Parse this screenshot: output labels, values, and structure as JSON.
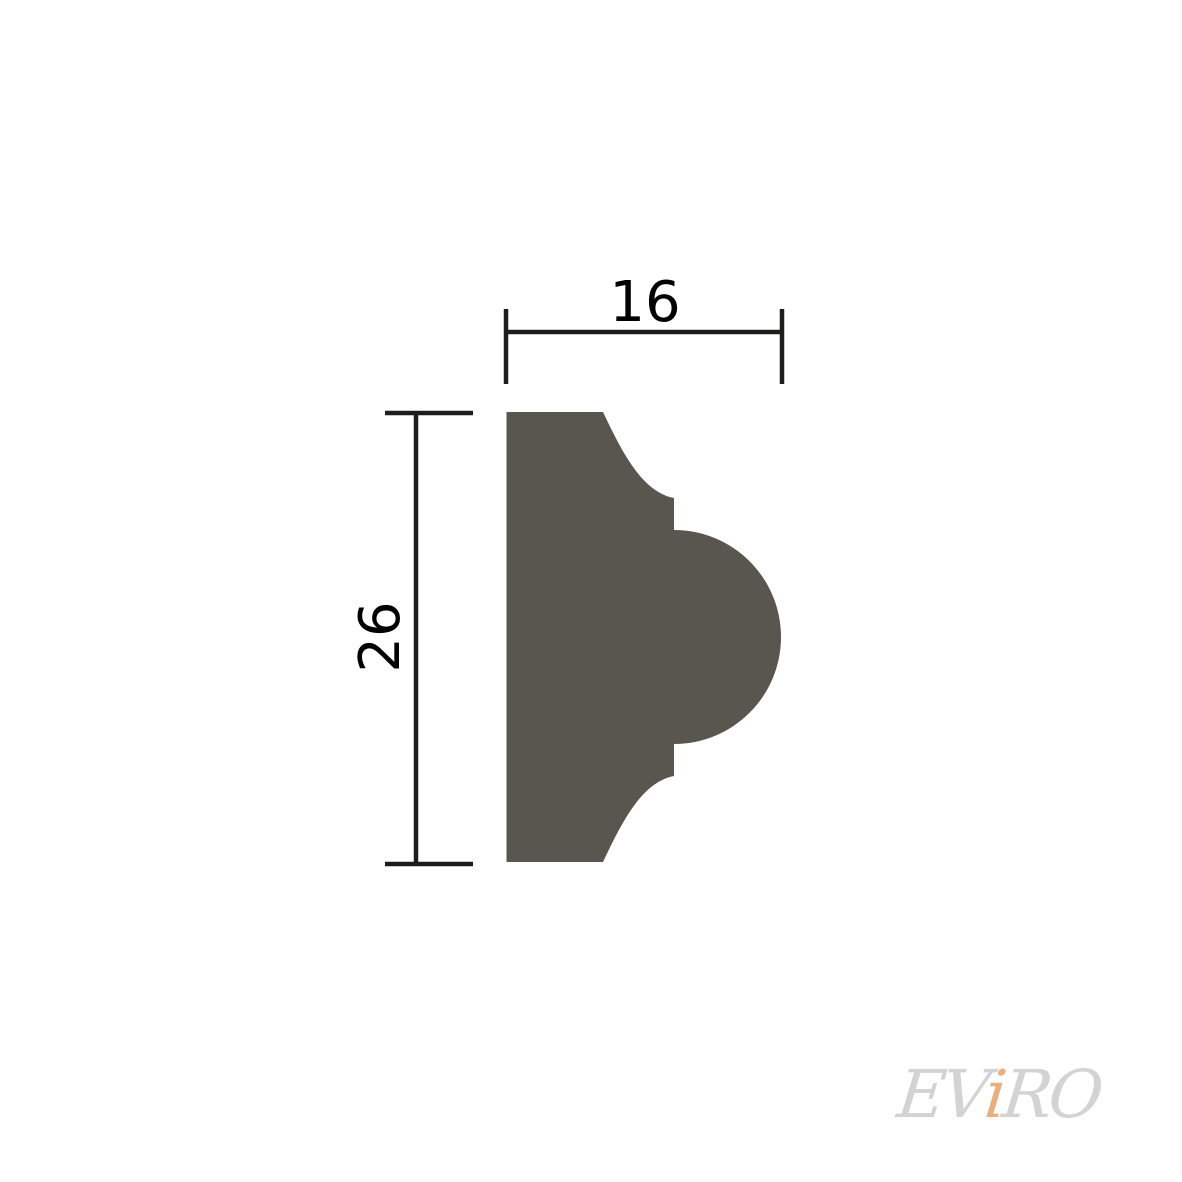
{
  "diagram": {
    "width_dimension": {
      "label": "16"
    },
    "height_dimension": {
      "label": "26"
    }
  },
  "watermark": {
    "prefix": "EV",
    "accent": "i",
    "suffix": "RO"
  },
  "colors": {
    "background": "#ffffff",
    "profile_fill": "#59564f",
    "dimension_line": "#1d1d1b",
    "dimension_text": "#000000",
    "watermark_gray": "#d3d3d5",
    "watermark_accent": "#e9af80"
  }
}
